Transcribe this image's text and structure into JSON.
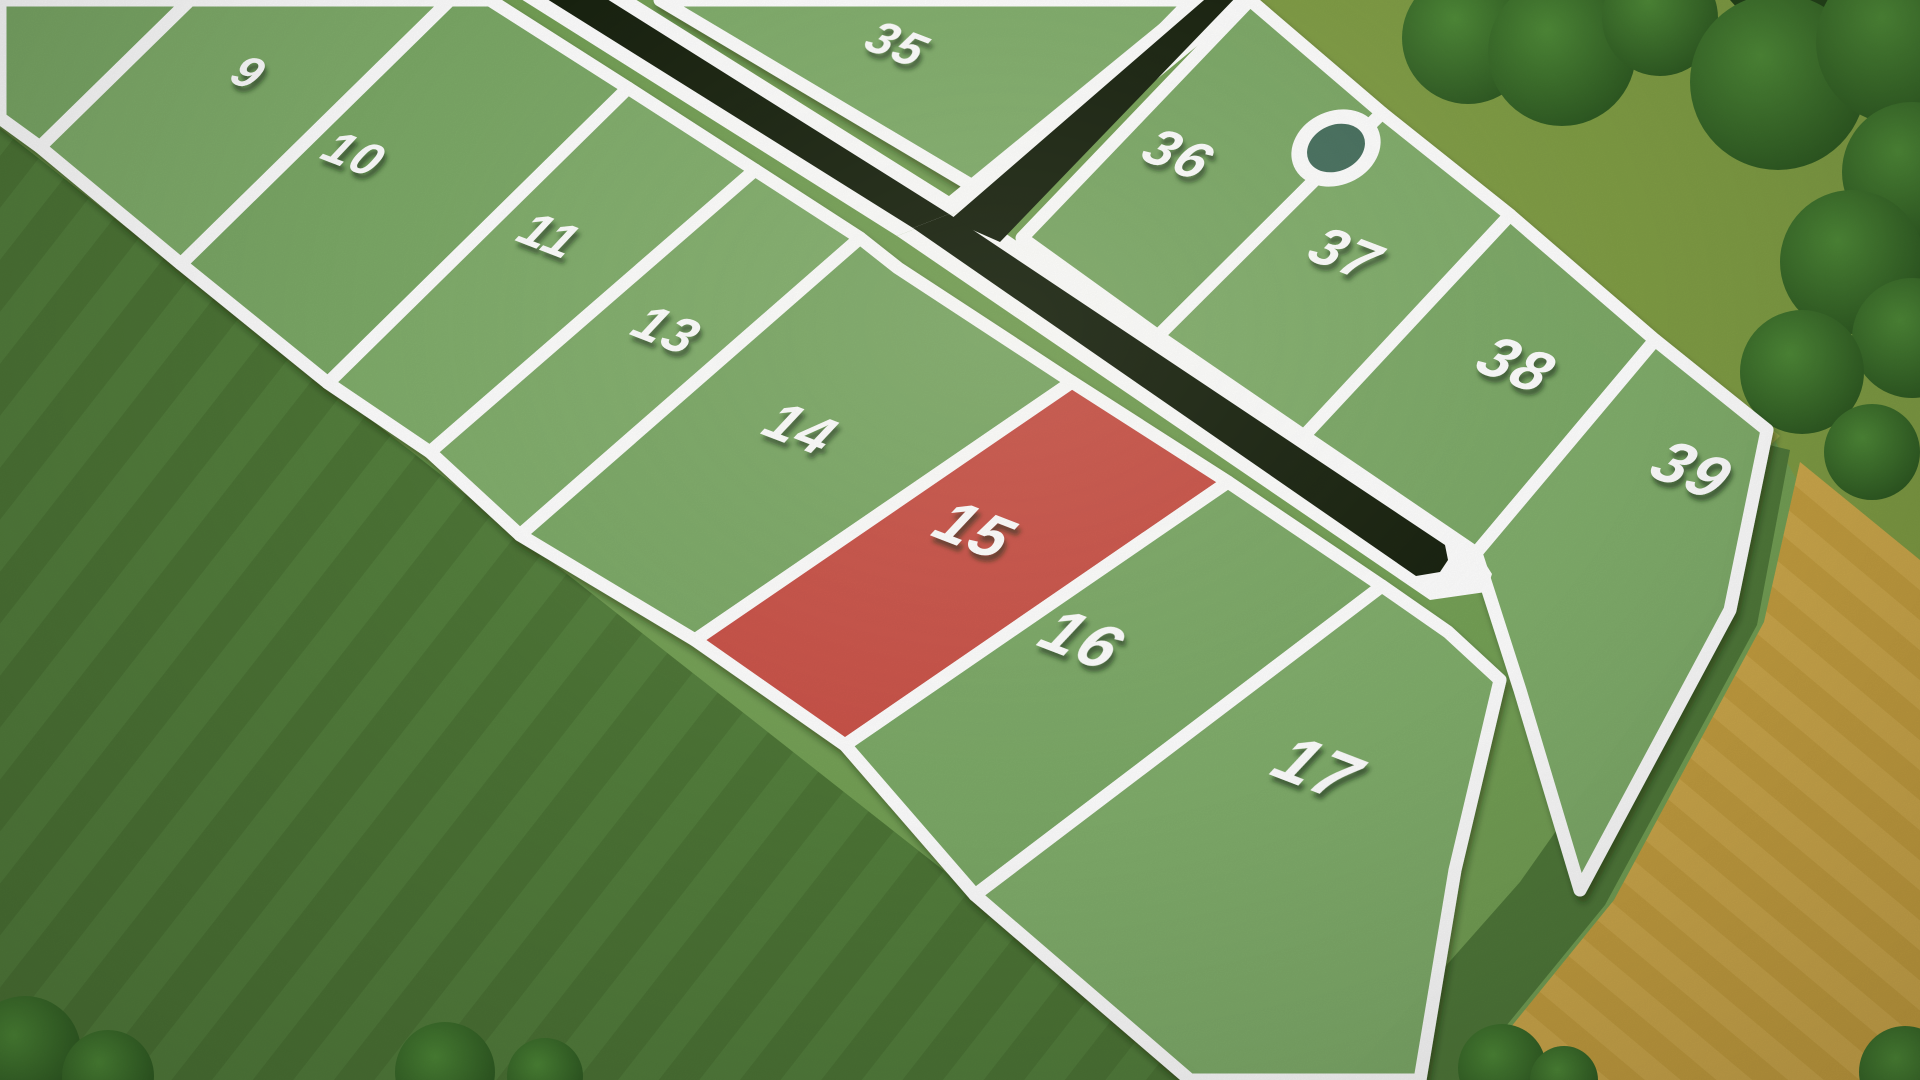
{
  "scene": {
    "width": 1920,
    "height": 1080
  },
  "colors": {
    "base_grass": "#74a055",
    "parcel_green": "#81ae6c",
    "parcel_green_alt": "#7dab68",
    "highlight_red": "#cd5149",
    "line_white": "#ffffff",
    "road_dark": "#18220f",
    "pond_fill": "#47705f",
    "dark_field": "#50793a",
    "dark_field_stripe": "#4a7233",
    "dark_field_stripe2": "#578440",
    "tan_field": "#c9a345",
    "tan_stripe": "#c09a3a",
    "tan_stripe2": "#d2ae52",
    "olive_grass": "#7f9c44",
    "boundary_grass": "#a7b254",
    "tree_dark": "#2b5520",
    "tree_mid": "#4f8a38",
    "hedge_dark": "#24431a",
    "label_shadow": "rgba(20,40,10,0.45)"
  },
  "map": {
    "label_rotate": 21,
    "label_skew": -12,
    "parcels": [
      {
        "id": "8",
        "label": "8",
        "status": "available",
        "points": [
          [
            0,
            0
          ],
          [
            190,
            0
          ],
          [
            40,
            147
          ],
          [
            0,
            118
          ]
        ],
        "label_pos": [
          150,
          -16
        ],
        "label_size": 44,
        "partial": true
      },
      {
        "id": "9",
        "label": "9",
        "status": "available",
        "points": [
          [
            190,
            0
          ],
          [
            450,
            0
          ],
          [
            181,
            264
          ],
          [
            40,
            147
          ]
        ],
        "label_pos": [
          240,
          86
        ],
        "label_size": 46
      },
      {
        "id": "10",
        "label": "10",
        "status": "available",
        "points": [
          [
            450,
            0
          ],
          [
            490,
            0
          ],
          [
            628,
            88
          ],
          [
            328,
            383
          ],
          [
            181,
            264
          ]
        ],
        "label_pos": [
          345,
          168
        ],
        "label_size": 48
      },
      {
        "id": "11",
        "label": "11",
        "status": "available",
        "points": [
          [
            628,
            88
          ],
          [
            755,
            170
          ],
          [
            430,
            452
          ],
          [
            328,
            383
          ]
        ],
        "label_pos": [
          540,
          250
        ],
        "label_size": 50
      },
      {
        "id": "13",
        "label": "13",
        "status": "available",
        "points": [
          [
            755,
            170
          ],
          [
            860,
            238
          ],
          [
            520,
            535
          ],
          [
            430,
            452
          ]
        ],
        "label_pos": [
          657,
          345
        ],
        "label_size": 52
      },
      {
        "id": "14",
        "label": "14",
        "status": "available",
        "points": [
          [
            860,
            238
          ],
          [
            898,
            268
          ],
          [
            1072,
            382
          ],
          [
            695,
            640
          ],
          [
            520,
            535
          ]
        ],
        "label_pos": [
          790,
          445
        ],
        "label_size": 56
      },
      {
        "id": "15",
        "label": "15",
        "status": "highlighted",
        "points": [
          [
            1072,
            382
          ],
          [
            1228,
            482
          ],
          [
            845,
            745
          ],
          [
            695,
            640
          ]
        ],
        "label_pos": [
          963,
          548
        ],
        "label_size": 62
      },
      {
        "id": "16",
        "label": "16",
        "status": "available",
        "points": [
          [
            1228,
            482
          ],
          [
            1382,
            586
          ],
          [
            975,
            895
          ],
          [
            845,
            745
          ]
        ],
        "label_pos": [
          1070,
          658
        ],
        "label_size": 64
      },
      {
        "id": "17",
        "label": "17",
        "status": "available",
        "points": [
          [
            1382,
            586
          ],
          [
            1448,
            632
          ],
          [
            1500,
            680
          ],
          [
            1455,
            870
          ],
          [
            1420,
            1080
          ],
          [
            1190,
            1080
          ],
          [
            975,
            895
          ]
        ],
        "label_pos": [
          1305,
          788
        ],
        "label_size": 68
      },
      {
        "id": "35",
        "label": "35",
        "status": "available",
        "points": [
          [
            660,
            0
          ],
          [
            1192,
            0
          ],
          [
            996,
            200
          ]
        ],
        "label_pos": [
          888,
          58
        ],
        "label_size": 48
      },
      {
        "id": "36",
        "label": "36",
        "status": "available",
        "points": [
          [
            1250,
            0
          ],
          [
            1382,
            113
          ],
          [
            1158,
            336
          ],
          [
            1022,
            238
          ]
        ],
        "label_pos": [
          1168,
          170
        ],
        "label_size": 54
      },
      {
        "id": "37",
        "label": "37",
        "status": "available",
        "points": [
          [
            1382,
            113
          ],
          [
            1510,
            215
          ],
          [
            1304,
            436
          ],
          [
            1158,
            336
          ]
        ],
        "label_pos": [
          1335,
          270
        ],
        "label_size": 56
      },
      {
        "id": "38",
        "label": "38",
        "status": "available",
        "points": [
          [
            1510,
            215
          ],
          [
            1655,
            340
          ],
          [
            1476,
            553
          ],
          [
            1304,
            436
          ]
        ],
        "label_pos": [
          1505,
          382
        ],
        "label_size": 60
      },
      {
        "id": "39",
        "label": "39",
        "status": "available",
        "points": [
          [
            1655,
            340
          ],
          [
            1767,
            430
          ],
          [
            1730,
            610
          ],
          [
            1580,
            890
          ],
          [
            1520,
            690
          ],
          [
            1476,
            553
          ]
        ],
        "label_pos": [
          1680,
          488
        ],
        "label_size": 62
      }
    ],
    "roads": {
      "white_polys": [
        [
          [
            513,
            -6
          ],
          [
            627,
            -6
          ],
          [
            968,
            208
          ],
          [
            897,
            236
          ]
        ],
        [
          [
            1196,
            -6
          ],
          [
            1260,
            -6
          ],
          [
            984,
            222
          ],
          [
            938,
            205
          ]
        ],
        [
          [
            897,
            236
          ],
          [
            968,
            208
          ],
          [
            1480,
            555
          ],
          [
            1492,
            574
          ],
          [
            1486,
            592
          ],
          [
            1430,
            600
          ]
        ]
      ],
      "dark_polys": [
        [
          [
            539,
            -6
          ],
          [
            599,
            -6
          ],
          [
            949,
            214
          ],
          [
            913,
            228
          ]
        ],
        [
          [
            1211,
            -6
          ],
          [
            1239,
            -6
          ],
          [
            1000,
            242
          ],
          [
            950,
            220
          ]
        ],
        [
          [
            913,
            228
          ],
          [
            949,
            214
          ],
          [
            1445,
            545
          ],
          [
            1448,
            560
          ],
          [
            1440,
            572
          ],
          [
            1416,
            576
          ]
        ]
      ]
    },
    "pond": {
      "cx": 1336,
      "cy": 148,
      "rot": -24,
      "outer_rx": 46,
      "outer_ry": 37,
      "inner_rx": 30,
      "inner_ry": 23
    }
  },
  "background": {
    "dark_field": [
      [
        0,
        128
      ],
      [
        1210,
        1080
      ],
      [
        0,
        1080
      ]
    ],
    "olive_area": [
      [
        1244,
        0
      ],
      [
        1920,
        0
      ],
      [
        1920,
        700
      ],
      [
        1770,
        432
      ],
      [
        1293,
        40
      ]
    ],
    "boundary_strip": [
      [
        1250,
        2
      ],
      [
        1780,
        436
      ],
      [
        1745,
        470
      ],
      [
        1228,
        42
      ]
    ],
    "se_dark_strip": [
      [
        1790,
        450
      ],
      [
        1757,
        625
      ],
      [
        1605,
        905
      ],
      [
        1462,
        1080
      ],
      [
        1345,
        1080
      ],
      [
        1520,
        882
      ],
      [
        1716,
        604
      ],
      [
        1748,
        440
      ]
    ],
    "tan_field": [
      [
        1800,
        462
      ],
      [
        1920,
        560
      ],
      [
        1920,
        1080
      ],
      [
        1468,
        1080
      ],
      [
        1614,
        900
      ],
      [
        1764,
        622
      ]
    ],
    "hedge": [
      [
        1730,
        0
      ],
      [
        1920,
        0
      ],
      [
        1920,
        95
      ],
      [
        1755,
        28
      ]
    ],
    "trees": [
      {
        "x": 1468,
        "y": 38,
        "r": 66
      },
      {
        "x": 1562,
        "y": 52,
        "r": 74
      },
      {
        "x": 1660,
        "y": 18,
        "r": 58
      },
      {
        "x": 1778,
        "y": 82,
        "r": 88
      },
      {
        "x": 1898,
        "y": 42,
        "r": 82
      },
      {
        "x": 1912,
        "y": 172,
        "r": 70
      },
      {
        "x": 1852,
        "y": 262,
        "r": 72
      },
      {
        "x": 1912,
        "y": 338,
        "r": 60
      },
      {
        "x": 1802,
        "y": 372,
        "r": 62
      },
      {
        "x": 1872,
        "y": 452,
        "r": 48
      },
      {
        "x": 25,
        "y": 1052,
        "r": 56
      },
      {
        "x": 108,
        "y": 1076,
        "r": 46
      },
      {
        "x": 445,
        "y": 1072,
        "r": 50
      },
      {
        "x": 545,
        "y": 1076,
        "r": 38
      },
      {
        "x": 1502,
        "y": 1068,
        "r": 44
      },
      {
        "x": 1564,
        "y": 1080,
        "r": 34
      },
      {
        "x": 1905,
        "y": 1072,
        "r": 46
      }
    ]
  }
}
